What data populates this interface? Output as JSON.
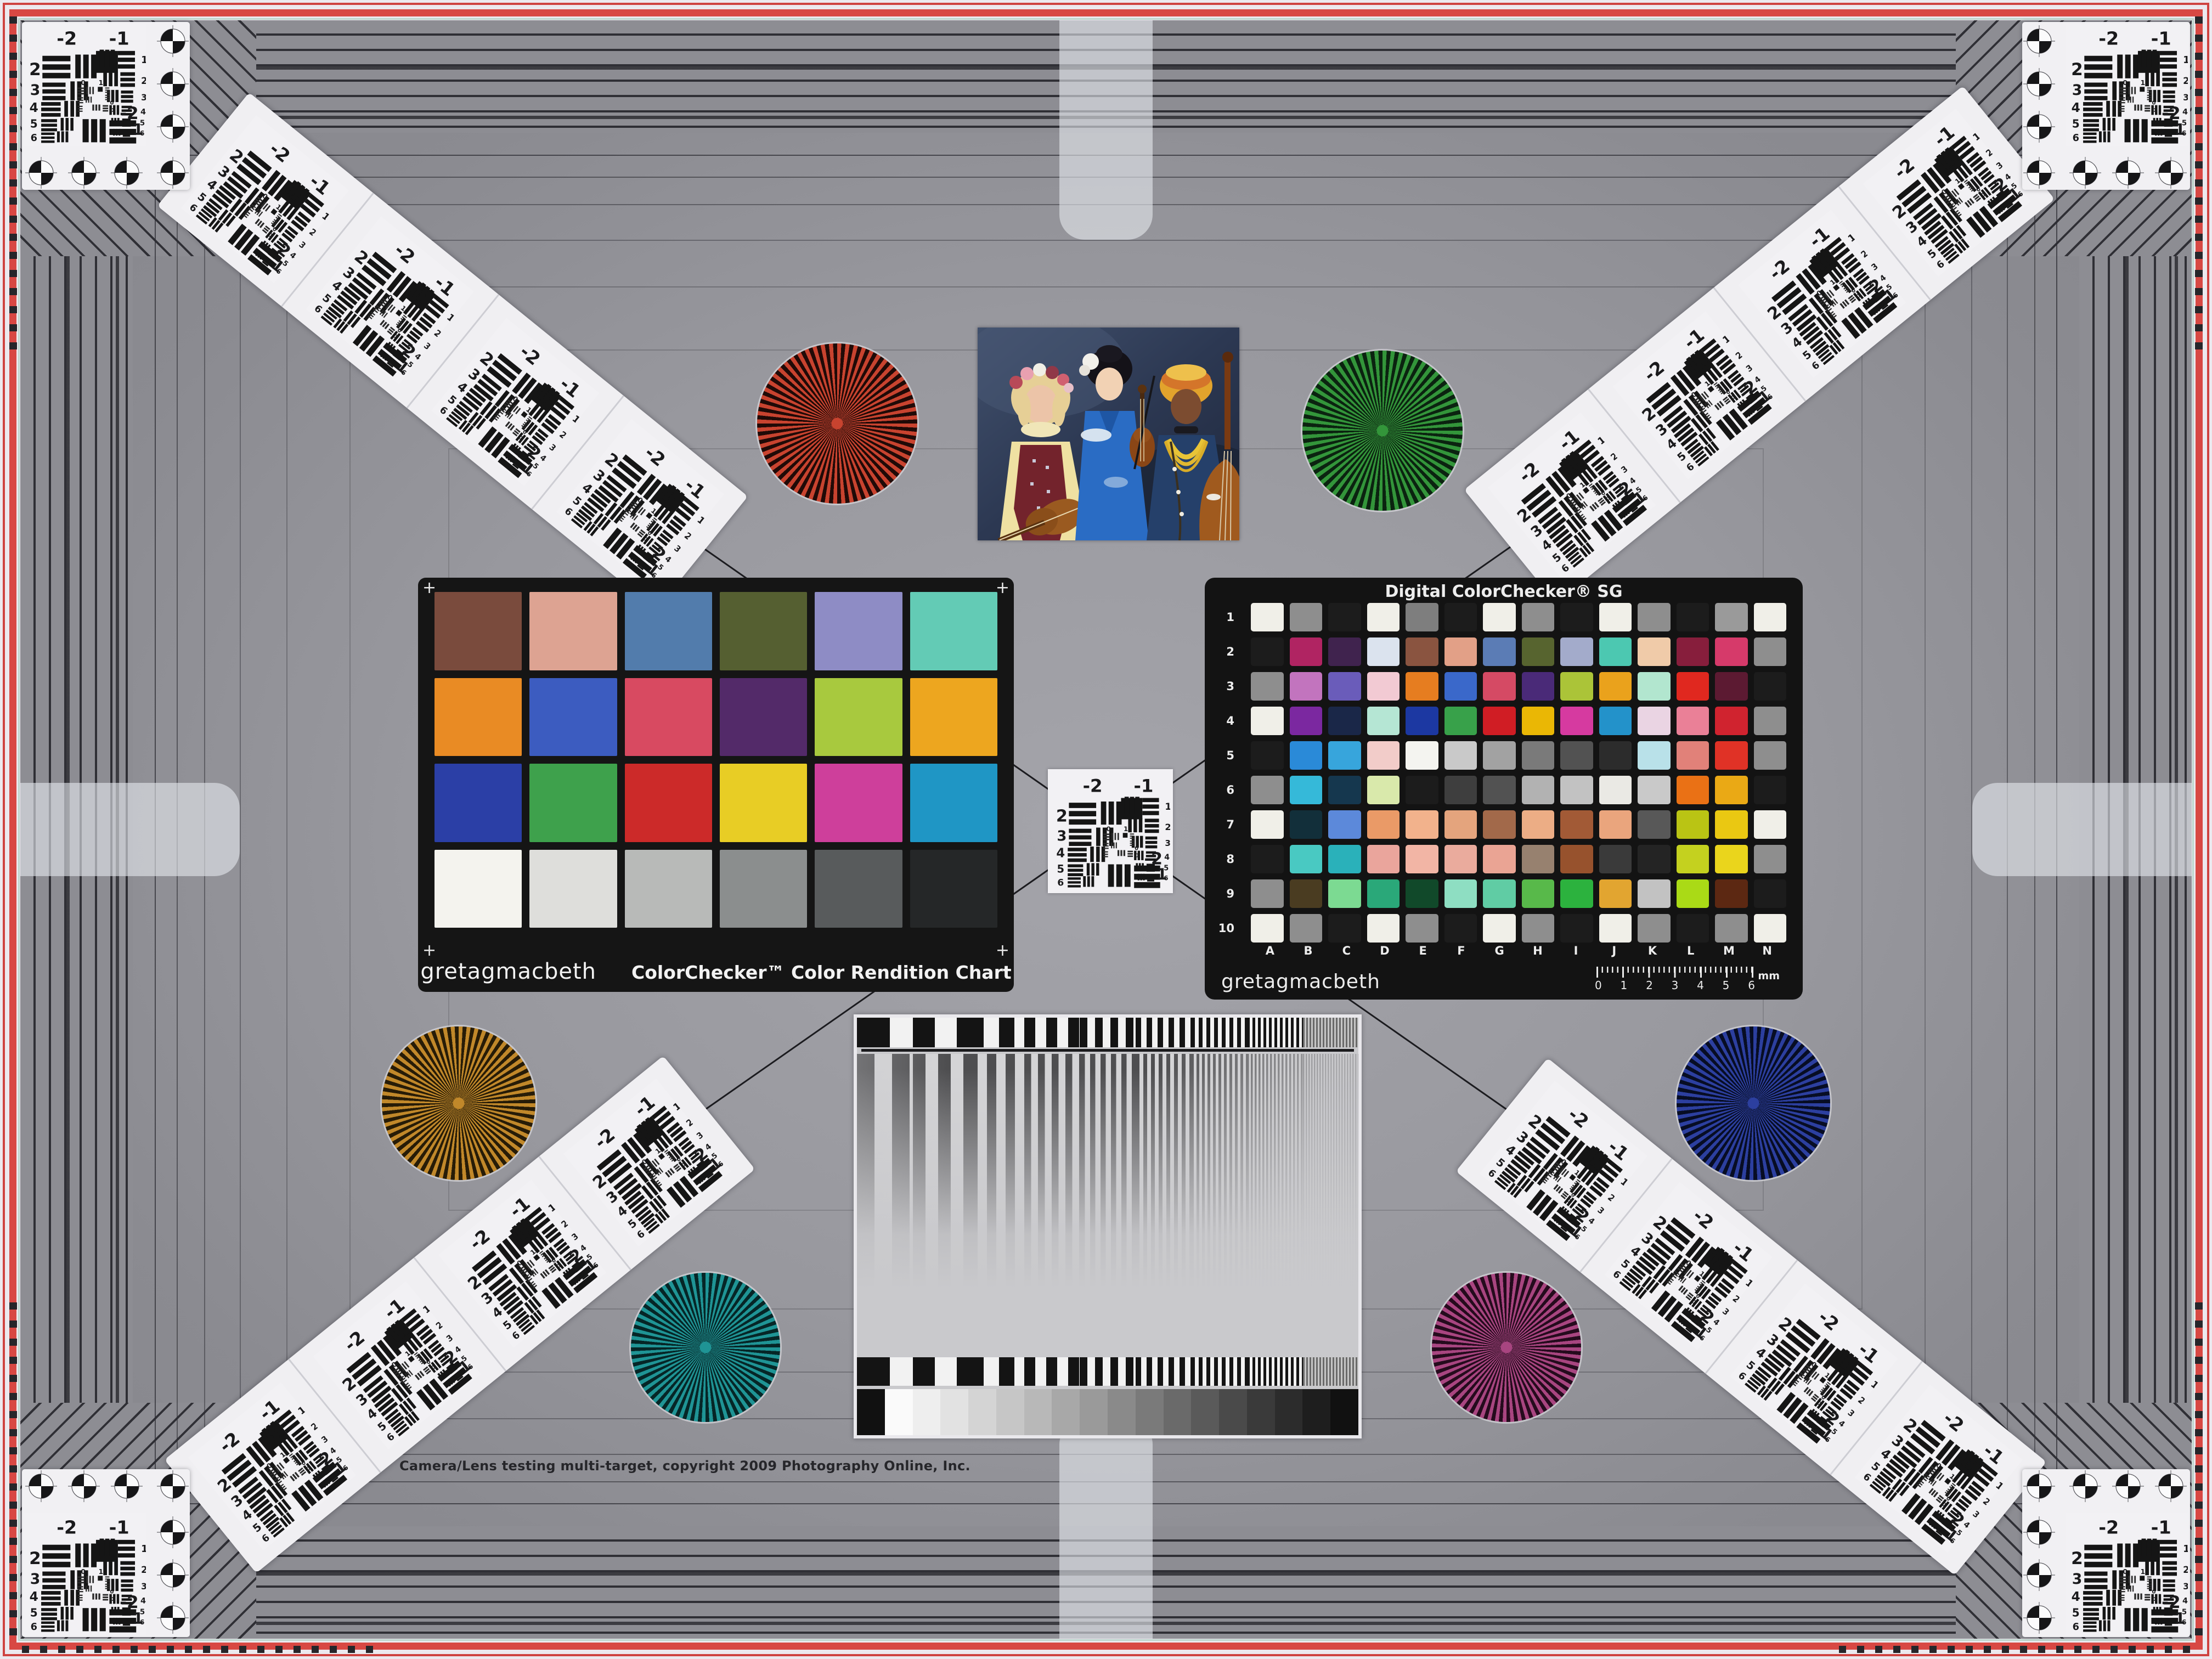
{
  "footer": {
    "copyright": "Camera/Lens testing multi-target, copyright 2009 Photography Online, Inc."
  },
  "usaf": {
    "top_left": "-2",
    "top_right": "-1",
    "left_numbers": [
      "2",
      "3",
      "4",
      "5",
      "6"
    ],
    "right_numbers": [
      "1",
      "2",
      "3",
      "4",
      "5",
      "6"
    ],
    "inner_zero": "0",
    "inner_one": "1",
    "bottom_label": "-2",
    "bottom_number": "1"
  },
  "colorchecker_classic": {
    "brand": "gretagmacbeth",
    "name": "ColorChecker™ Color Rendition Chart",
    "corner_mark": "+",
    "patches": [
      [
        "#7a4b3d",
        "#dda392",
        "#527cac",
        "#555f31",
        "#8e8cc5",
        "#63cbb5"
      ],
      [
        "#e98b24",
        "#3c5cc0",
        "#d84a61",
        "#532a69",
        "#a8c93e",
        "#eda61f"
      ],
      [
        "#2b3fa6",
        "#3ea14c",
        "#cc2a29",
        "#e8cd25",
        "#ce3f9b",
        "#1f96c5"
      ],
      [
        "#f4f3ee",
        "#dededb",
        "#b8bab8",
        "#8b8e8e",
        "#585b5c",
        "#252728"
      ]
    ]
  },
  "colorchecker_sg": {
    "title": "Digital ColorChecker® SG",
    "brand": "gretagmacbeth",
    "row_labels": [
      "1",
      "2",
      "3",
      "4",
      "5",
      "6",
      "7",
      "8",
      "9",
      "10"
    ],
    "col_labels": [
      "A",
      "B",
      "C",
      "D",
      "E",
      "F",
      "G",
      "H",
      "I",
      "J",
      "K",
      "L",
      "M",
      "N"
    ],
    "ruler_numbers": [
      "0",
      "1",
      "2",
      "3",
      "4",
      "5",
      "6"
    ],
    "ruler_unit": "mm",
    "patches": [
      [
        "#f0efe8",
        "#8e8e8e",
        "#1c1c1c",
        "#f0efe8",
        "#7e7e7e",
        "#1c1c1c",
        "#f0efe8",
        "#8e8e8e",
        "#1c1c1c",
        "#f0efe8",
        "#8e8e8e",
        "#1c1c1c",
        "#9a9a9a",
        "#f0efe8"
      ],
      [
        "#1c1c1c",
        "#b02462",
        "#40234e",
        "#dbe3ee",
        "#8a5440",
        "#e2a087",
        "#5b7cb5",
        "#57642f",
        "#a3abcb",
        "#4cc8b1",
        "#f0cba9",
        "#871e3c",
        "#d63a6a",
        "#8e8e8e"
      ],
      [
        "#8e8e8e",
        "#c274be",
        "#6a5cba",
        "#f2cad3",
        "#e67d20",
        "#3a68ca",
        "#d54a64",
        "#4a2a78",
        "#abc438",
        "#eaa21c",
        "#b2e6cf",
        "#e0281f",
        "#5c1a32",
        "#1c1c1c"
      ],
      [
        "#f0efe8",
        "#7b28a0",
        "#1a2748",
        "#b5e6d4",
        "#1c38a2",
        "#38a14a",
        "#d01d24",
        "#eab705",
        "#d63aa0",
        "#2392ca",
        "#ead4e3",
        "#ea8097",
        "#d0232f",
        "#8e8e8e"
      ],
      [
        "#1c1c1c",
        "#2a8ad8",
        "#37a5dc",
        "#f2ccc9",
        "#f4f4f0",
        "#c9c9c9",
        "#a2a2a2",
        "#7a7a7a",
        "#525252",
        "#2c2c2c",
        "#b9e1e9",
        "#e18179",
        "#e03226",
        "#8e8e8e"
      ],
      [
        "#8e8e8e",
        "#35b9d9",
        "#15374e",
        "#d9e9ab",
        "#1c1c1c",
        "#3e3e3e",
        "#525252",
        "#b2b2b2",
        "#c2c2c2",
        "#eae9e4",
        "#c9c9c9",
        "#ea7115",
        "#eaa915",
        "#1c1c1c"
      ],
      [
        "#f0efe8",
        "#122f3a",
        "#5c89da",
        "#ea9a67",
        "#f2b28c",
        "#e4a47d",
        "#a2694a",
        "#ecad85",
        "#a25a36",
        "#eaa57d",
        "#585858",
        "#bac414",
        "#eac812",
        "#f0efe8"
      ],
      [
        "#1c1c1c",
        "#49c9c2",
        "#2ab1ba",
        "#eaa59c",
        "#f2b5a5",
        "#eaab9d",
        "#eaa494",
        "#97816f",
        "#97522d",
        "#3a3a3a",
        "#242424",
        "#c4d11f",
        "#ead51c",
        "#8e8e8e"
      ],
      [
        "#8e8e8e",
        "#4a3c21",
        "#7cda92",
        "#2aa879",
        "#11492a",
        "#8edec2",
        "#60cca4",
        "#58b94a",
        "#2cb23e",
        "#e2a530",
        "#c2c2c2",
        "#aada16",
        "#5c2812",
        "#1c1c1c"
      ],
      [
        "#f0efe8",
        "#8e8e8e",
        "#1c1c1c",
        "#f0efe8",
        "#8e8e8e",
        "#1c1c1c",
        "#f0efe8",
        "#8e8e8e",
        "#1c1c1c",
        "#f0efe8",
        "#8e8e8e",
        "#1c1c1c",
        "#8e8e8e",
        "#f0efe8"
      ]
    ]
  },
  "sweep_chart": {
    "step_wedge": [
      "#111111",
      "#fafafa",
      "#eeeeee",
      "#e2e2e2",
      "#d4d4d4",
      "#c6c6c6",
      "#b8b8b8",
      "#a8a8a8",
      "#9a9a9a",
      "#8a8a8a",
      "#7a7a7a",
      "#6a6a6a",
      "#5a5a5a",
      "#4a4a4a",
      "#3a3a3a",
      "#2c2c2c",
      "#1e1e1e",
      "#111111"
    ]
  },
  "stars": {
    "red": {
      "color": "#c8432f",
      "dark": "#200a07"
    },
    "green": {
      "color": "#33953a",
      "dark": "#0b2310"
    },
    "gold": {
      "color": "#c1882a",
      "dark": "#271c07"
    },
    "blue": {
      "color": "#2c3f9f",
      "dark": "#070d24"
    },
    "teal": {
      "color": "#1f9495",
      "dark": "#062627"
    },
    "magenta": {
      "color": "#a84580",
      "dark": "#250b1d"
    }
  }
}
